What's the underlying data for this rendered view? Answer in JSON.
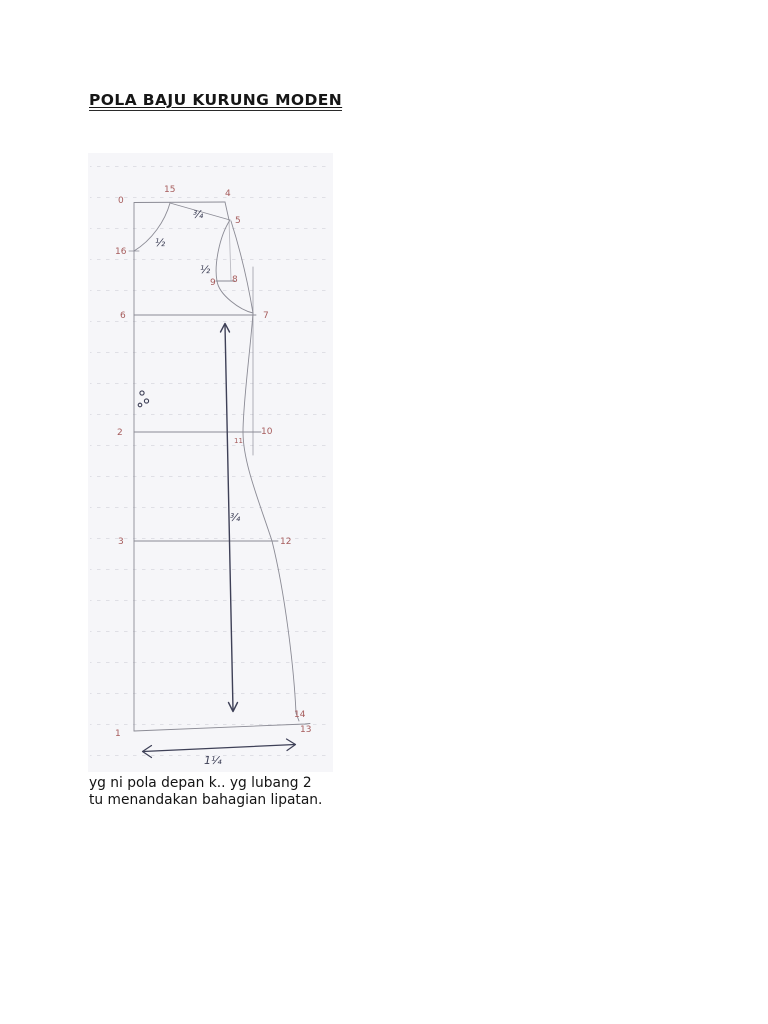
{
  "document": {
    "title": "POLA BAJU KURUNG MODEN",
    "caption_line1": "yg ni pola depan k.. yg lubang 2",
    "caption_line2": "tu menandakan bahagian lipatan."
  },
  "diagram": {
    "point_labels": {
      "p0": "0",
      "p1": "1",
      "p2": "2",
      "p3": "3",
      "p4": "4",
      "p5": "5",
      "p6": "6",
      "p7": "7",
      "p8": "8",
      "p9": "9",
      "p10": "10",
      "p11": "11",
      "p12": "12",
      "p13": "13",
      "p14": "14",
      "p15": "15",
      "p16": "16"
    },
    "measurements": {
      "shoulder": "¾",
      "neck_curve": "½",
      "armhole": "½",
      "grain_line": "¾",
      "hem_width": "1¼"
    },
    "colors": {
      "point_label_red": "#a65c5c",
      "ink_navy": "#3e4057",
      "pencil_gray": "#8b8b95",
      "paper": "#f6f6f9",
      "dotted_guide": "#dcdce3"
    }
  }
}
